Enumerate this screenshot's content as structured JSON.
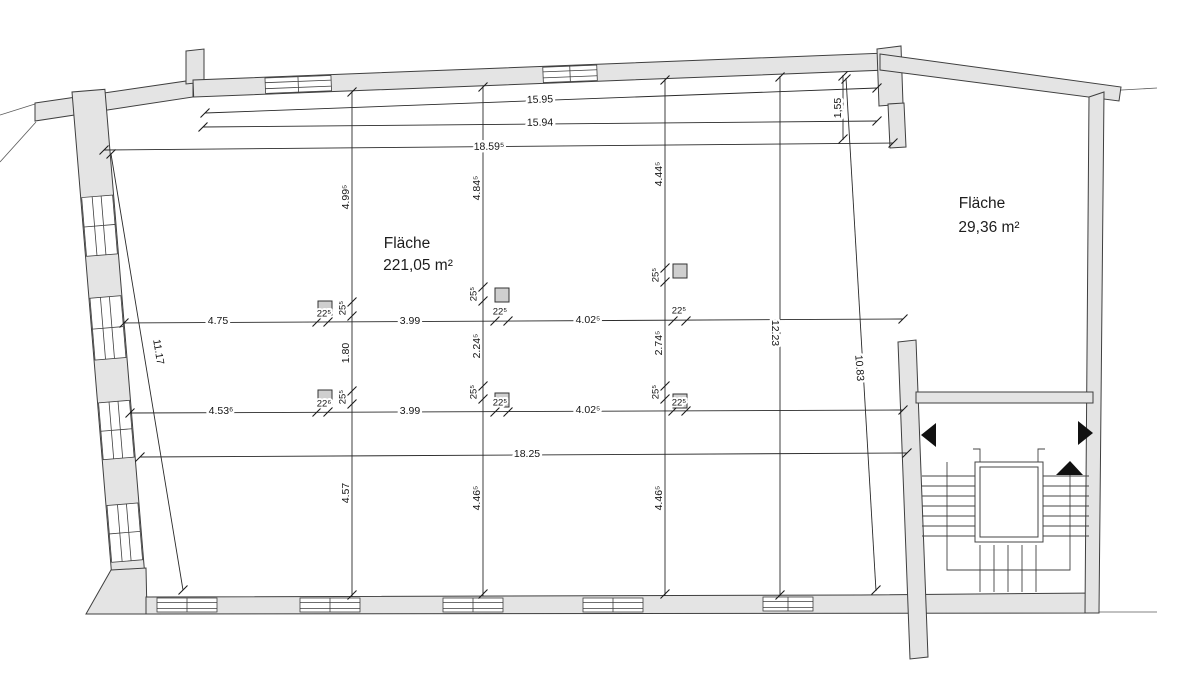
{
  "areas": {
    "main": {
      "label": "Fläche",
      "value": "221,05 m²"
    },
    "side": {
      "label": "Fläche",
      "value": "29,36 m²"
    }
  },
  "dims": {
    "top_outer": "15.95",
    "top_inner": "15.94",
    "top_overall": "18.59⁵",
    "offset_right": "1,55",
    "left_wall": "11.17",
    "grid_top_1": "4.99⁵",
    "grid_top_2": "4.84⁵",
    "grid_top_3": "4.44⁵",
    "row1_seg1": "4.75",
    "row1_seg2": "3.99",
    "row1_seg3": "4.02⁵",
    "row2_seg1": "4.53⁶",
    "row2_seg2": "3.99",
    "row2_seg3": "4.02⁵",
    "mid_1": "1.80",
    "mid_2": "2.24⁵",
    "mid_3": "2.74⁵",
    "grid_bot_1": "4.57",
    "grid_bot_2": "4.46⁵",
    "grid_bot_3": "4.46⁵",
    "span_bottom": "18.25",
    "right_inner": "12.23",
    "right_room": "10.83",
    "col_width": "22⁵",
    "col_width_alt": "22⁶",
    "col_depth": "25⁵"
  },
  "colors": {
    "wall_fill": "#e4e4e4",
    "line": "#2a2a2a",
    "background": "#ffffff"
  }
}
